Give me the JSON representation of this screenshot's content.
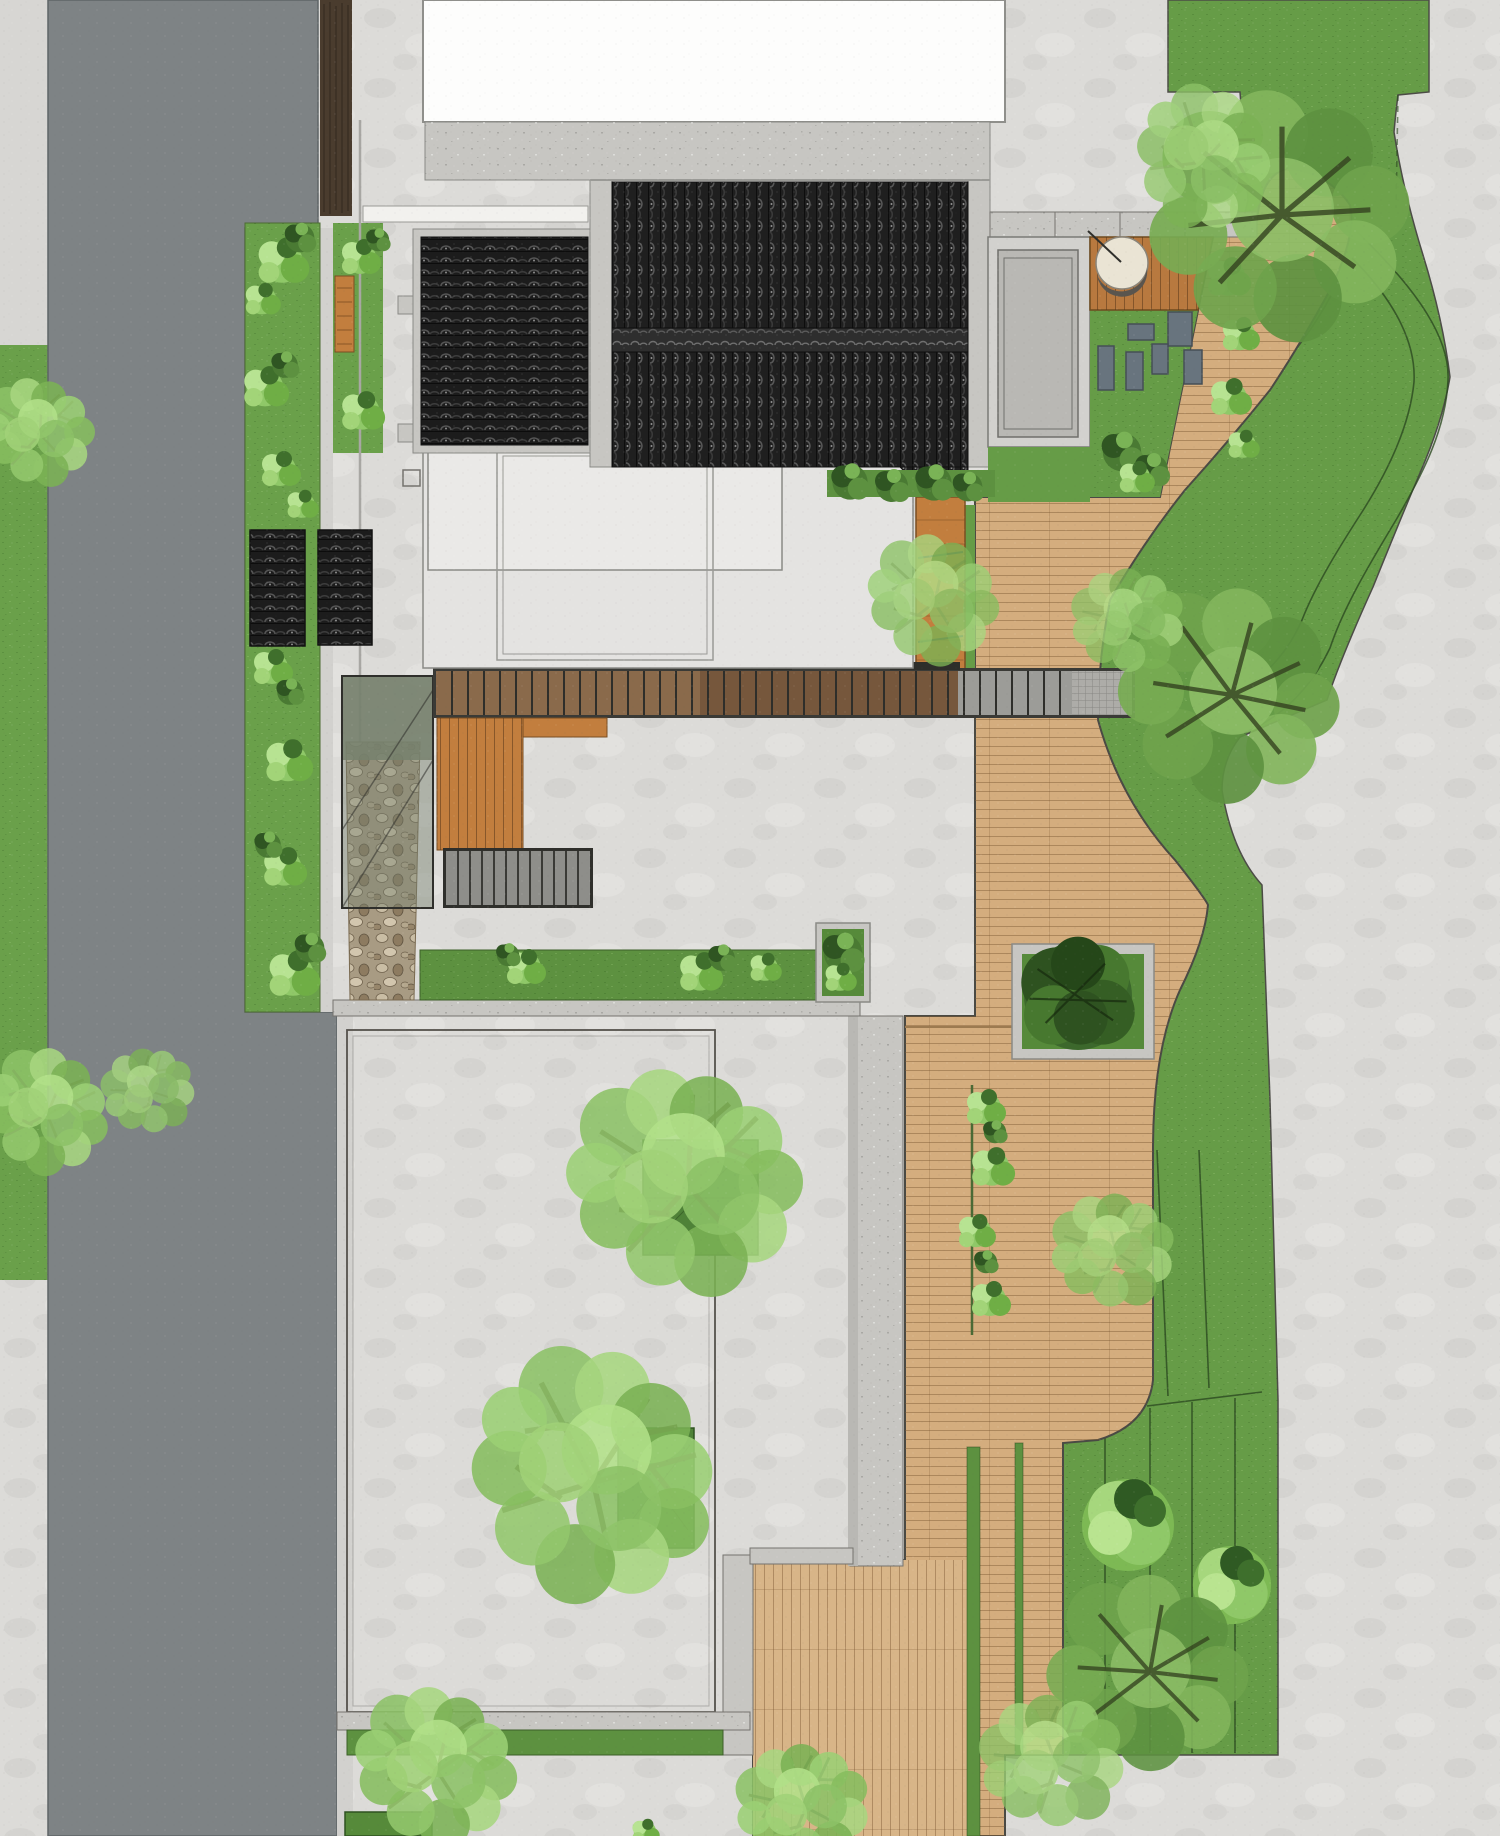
{
  "title": "Courtyard House Landscape Site Plan",
  "canvas": {
    "width": 1500,
    "height": 1836
  },
  "palette": {
    "paving": "#dcdbd8",
    "paving_right": "#d9d9d6",
    "courtyard": "#dedddb",
    "road": "#7e8385",
    "sidewalk": "#d7d6d3",
    "wall_brown": "#4a3c2e",
    "concrete": "#c7c6c2",
    "concrete_light": "#d2d1ce",
    "concrete_dark": "#b9b8b4",
    "white_roof": "#fdfdfc",
    "flat_roof": "#e4e3e1",
    "flat_roof_inner": "#eae9e7",
    "tile_dark": "#1c1c1c",
    "ridge": "#2e2e2e",
    "lawn": "#6aa04a",
    "lawn_band": "#669c47",
    "hedge": "#5d9140",
    "planter_grass": "#568a3a",
    "tree_planter": "#4f8238",
    "deck": "#d4ad7e",
    "deck_light": "#d8b588",
    "deck_dark": "#b8793f",
    "bench": "#c27e3e",
    "corridor_wood_a": "#8a6a4b",
    "corridor_wood_b": "#76573c",
    "corridor_gray": "#9c9c98",
    "landing": "#adaca8",
    "stair": "#8e8e8a",
    "canopy": "#76816e",
    "pebble_bg": "#a89b83",
    "stone": "#68747e",
    "stone_border": "#454e56",
    "firebowl": "#eae4d4",
    "firebowl_rim": "#5a554e",
    "outline": "#4a4a44",
    "contour": "#2c4a20",
    "frame": "#8a8a85"
  },
  "features": [
    {
      "name": "street-road",
      "kind": "asphalt road, west side"
    },
    {
      "name": "street-lawn-verge",
      "kind": "planted verge with shrubs"
    },
    {
      "name": "timber-privacy-wall",
      "kind": "dark timber wall strip at north-west"
    },
    {
      "name": "white-flat-roof-building",
      "kind": "neighbouring building footprint, north"
    },
    {
      "name": "main-hall-tiled-roof",
      "kind": "grey Chinese tile gable roof with ridge"
    },
    {
      "name": "west-wing-tiled-roof",
      "kind": "grey tile roof, horizontal courses"
    },
    {
      "name": "garden-pavilion-roofs",
      "kind": "two small tiled garden roofs"
    },
    {
      "name": "south-flat-roof-pavilion",
      "kind": "flat roofed volume with framed edge"
    },
    {
      "name": "glass-canopy",
      "kind": "translucent canopy over side passage"
    },
    {
      "name": "pebble-path",
      "kind": "river-stone drainage strip"
    },
    {
      "name": "stair-corridor",
      "kind": "long stepped walkway with timber treads"
    },
    {
      "name": "garden-stairs",
      "kind": "lower flight of steps"
    },
    {
      "name": "timber-deck-path",
      "kind": "winding wooden deck through east garden"
    },
    {
      "name": "fire-bowl-terrace",
      "kind": "small deck terrace with fire bowl"
    },
    {
      "name": "stepping-stones",
      "kind": "bluestone pavers on lawn"
    },
    {
      "name": "deck-planter",
      "kind": "square planter in deck with tree"
    },
    {
      "name": "paved-courtyard",
      "kind": "large south courtyard with two trees"
    },
    {
      "name": "courtyard-tree-planters",
      "kind": "square tree pits"
    },
    {
      "name": "hedge-strips",
      "kind": "clipped lawn/hedge bands along walls"
    },
    {
      "name": "east-lawn-slope",
      "kind": "contoured lawn band with terraces"
    },
    {
      "name": "neighbor-paving",
      "kind": "light paving, east plot"
    }
  ],
  "counts": {
    "large_trees": 10,
    "shrub_clusters": 24,
    "stepping_stones": 6
  },
  "notes": "top-down architectural landscape rendering; no text labels visible"
}
